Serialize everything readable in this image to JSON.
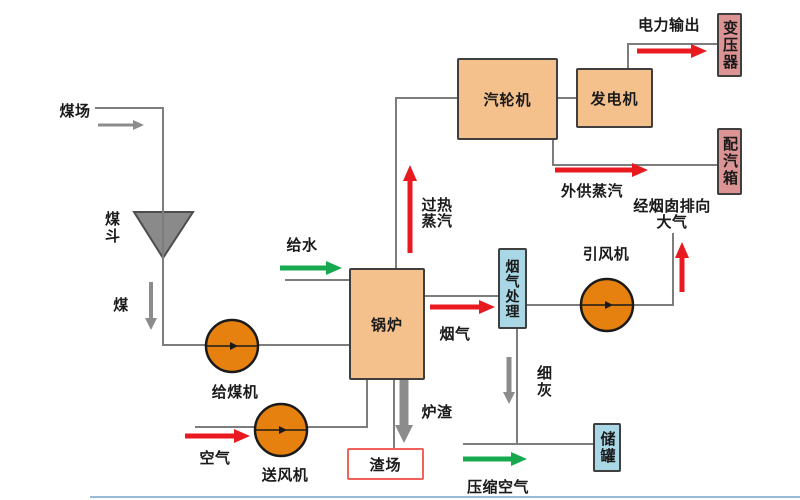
{
  "equipment": {
    "coal_hopper": "煤斗",
    "coal_feeder": "给煤机",
    "forced_draft_fan": "送风机",
    "boiler": "锅炉",
    "turbine": "汽轮机",
    "generator": "发电机",
    "transformer": "变压器",
    "steam_distribution_box": "配汽箱",
    "flue_gas_treatment": "烟气处理",
    "induced_draft_fan": "引风机",
    "slag_yard": "渣场",
    "storage_tank": "储罐"
  },
  "flows": {
    "coal_yard": "煤场",
    "coal": "煤",
    "air": "空气",
    "feed_water": "给水",
    "superheated_steam_line1": "过热",
    "superheated_steam_line2": "蒸汽",
    "power_output": "电力输出",
    "external_steam": "外供蒸汽",
    "flue_gas": "烟气",
    "to_chimney_line1": "经烟囱排向",
    "to_chimney_line2": "大气",
    "fine_ash": "细灰",
    "slag": "炉渣",
    "compressed_air": "压缩空气"
  },
  "colors": {
    "process_box_fill": "#f4c08c",
    "output_box_fill": "#db9393",
    "treatment_box_fill": "#a9d7e5",
    "fan_circle_fill": "#e6800f",
    "hopper_fill": "#8a8a8a",
    "slag_yard_border": "#f0625a",
    "red_arrow": "#e8191f",
    "green_arrow": "#17a94f",
    "gray_arrow": "#8c8c8c",
    "connector_line": "#7d7d7d"
  }
}
